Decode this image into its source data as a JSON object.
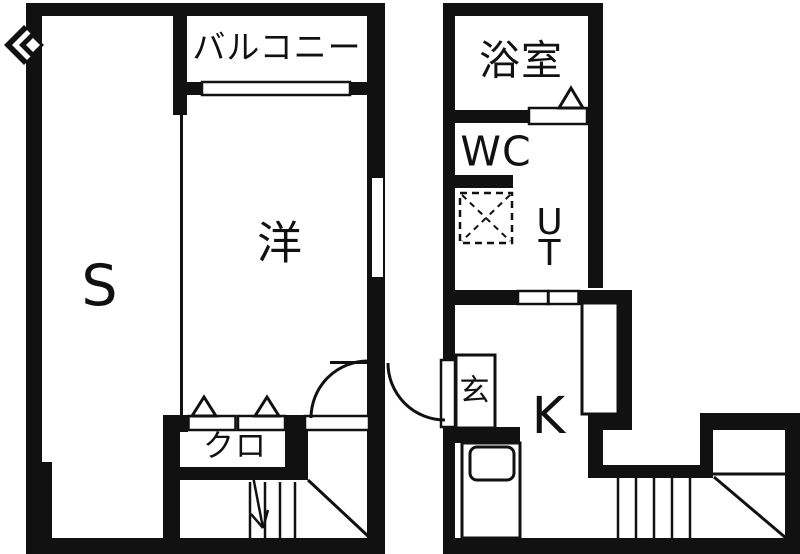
{
  "plan": {
    "type": "apartment-floor-plan",
    "colors": {
      "wall": "#111111",
      "background": "#ffffff"
    },
    "units": {
      "left": {
        "rooms": {
          "balcony": {
            "label": "バルコニー"
          },
          "storage": {
            "label": "S"
          },
          "western_room": {
            "label": "洋"
          },
          "closet": {
            "label": "クロ"
          }
        }
      },
      "right": {
        "rooms": {
          "bathroom": {
            "label": "浴室"
          },
          "toilet": {
            "label": "WC"
          },
          "utility": {
            "label": "UT"
          },
          "entrance": {
            "label": "玄"
          },
          "kitchen": {
            "label": "K"
          }
        }
      }
    },
    "symbols": [
      "door-swing-arc",
      "folding-door-triangle",
      "sliding-door",
      "washing-machine-pan",
      "kitchen-sink",
      "staircase",
      "stair-direction-arrow",
      "bay-window-mark"
    ]
  }
}
